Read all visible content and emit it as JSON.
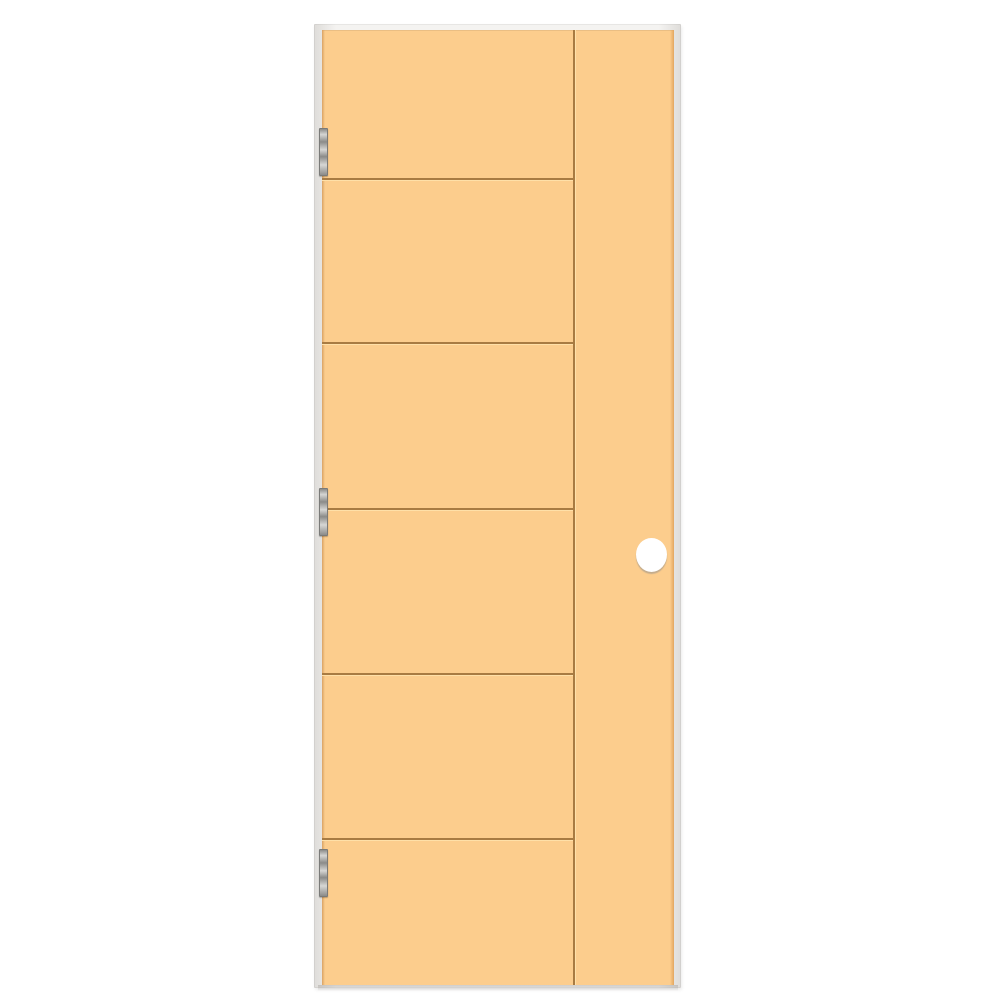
{
  "scene": {
    "type": "product-photo",
    "subject": "prehung-interior-flush-door",
    "background_color": "#ffffff"
  },
  "frame": {
    "color_outer": "#dedcd9",
    "color_inner": "#f4f3f1"
  },
  "door": {
    "slab_color": "#fccd8d",
    "slab_edge_left_color": "#d9a264",
    "slab_edge_right_color": "#e3a65f",
    "groove_color": "#a87b42",
    "groove_highlight_color": "#ffe0a8",
    "panel_count": 6,
    "horizontal_groove_y_px": [
      178,
      342,
      508,
      673,
      838
    ],
    "vertical_groove_x_px": 573
  },
  "hinges": {
    "count": 3,
    "color_light": "#d6d6d4",
    "color_dark": "#8b8b89",
    "border_color": "#7a7a78",
    "x_px": 319,
    "width_px": 9,
    "height_px": 48,
    "positions_y_px": [
      128,
      488,
      849
    ]
  },
  "bore_hole": {
    "color": "#ffffff",
    "shadow_color": "rgba(150,145,140,0.55)",
    "center_x_px": 651,
    "center_y_px": 555,
    "width_px": 31,
    "height_px": 34
  }
}
